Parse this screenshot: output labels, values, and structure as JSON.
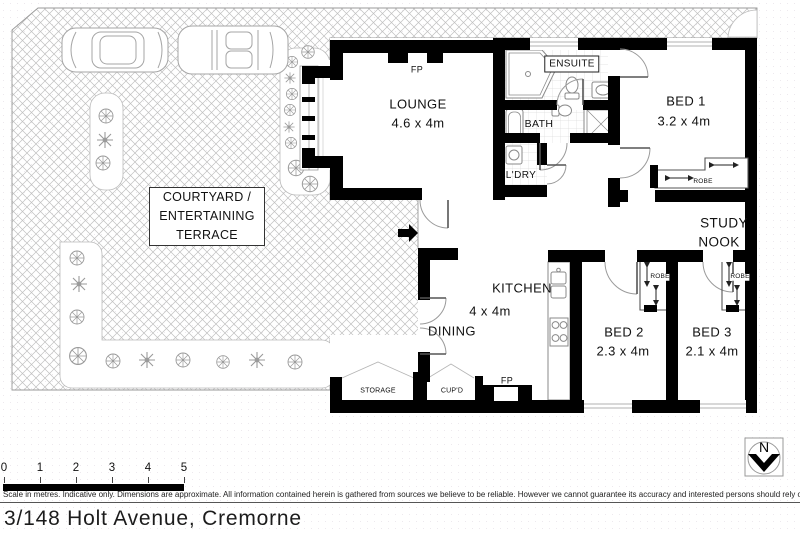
{
  "address": "3/148 Holt Avenue, Cremorne",
  "disclaimer": "Scale in metres. Indicative only. Dimensions are approximate. All information contained herein is gathered from sources we believe to be reliable. However we cannot guarantee its accuracy and interested persons should rely on their own enquires",
  "north_label": "N",
  "scale_ticks": [
    "0",
    "1",
    "2",
    "3",
    "4",
    "5"
  ],
  "rooms": {
    "courtyard_line1": "COURTYARD /",
    "courtyard_line2": "ENTERTAINING",
    "courtyard_line3": "TERRACE",
    "lounge_name": "LOUNGE",
    "lounge_dims": "4.6 x 4m",
    "ensuite": "ENSUITE",
    "bath": "BATH",
    "laundry": "L'DRY",
    "bed1_name": "BED 1",
    "bed1_dims": "3.2 x 4m",
    "study_line1": "STUDY",
    "study_line2": "NOOK",
    "kitchen_name": "KITCHEN",
    "kitchen_dims": "4 x 4m",
    "dining": "DINING",
    "bed2_name": "BED 2",
    "bed2_dims": "2.3 x 4m",
    "bed3_name": "BED 3",
    "bed3_dims": "2.1 x 4m",
    "robe_bed1": "ROBE",
    "robe_bed2": "ROBE",
    "robe_bed3": "ROBE",
    "storage": "STORAGE",
    "cupboard": "CUP'D",
    "fp_lounge": "FP",
    "fp_kitchen": "FP"
  },
  "colors": {
    "wall": "#000000",
    "hatch": "#c0c0c0",
    "fixture": "#8a8a8a",
    "text": "#111111"
  }
}
